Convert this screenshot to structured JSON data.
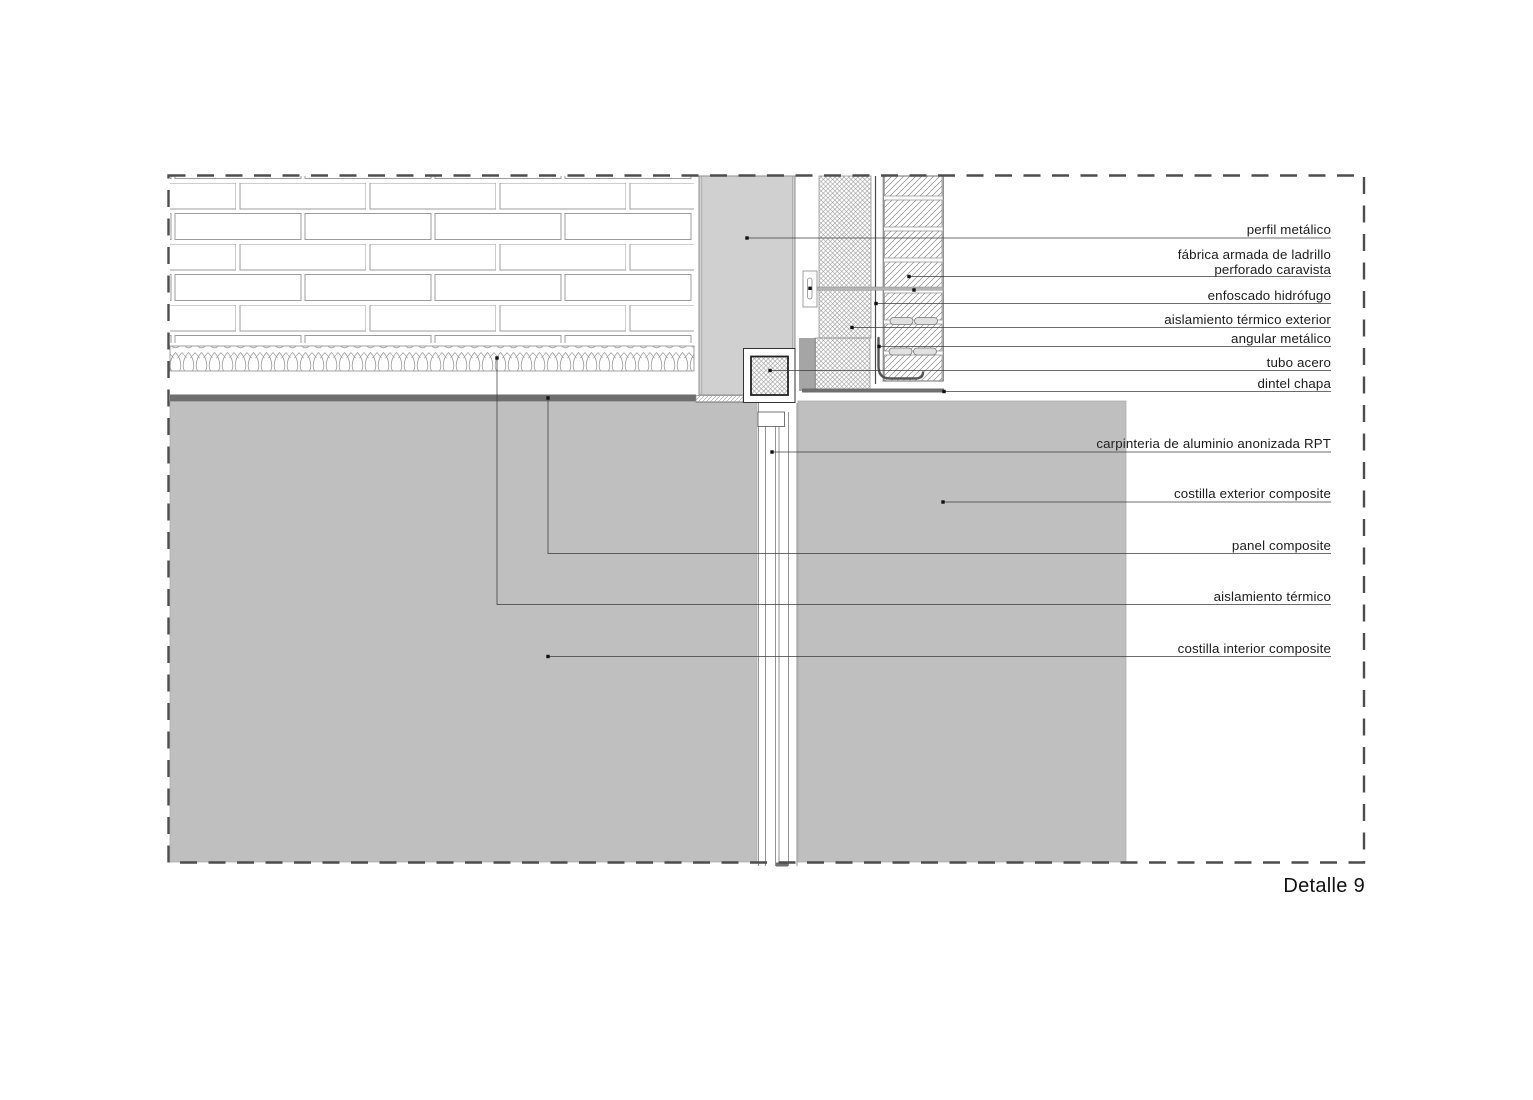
{
  "title": "Detalle 9",
  "callouts": {
    "upper": [
      {
        "label": "perfil metálico"
      },
      {
        "label": "fábrica armada de ladrillo",
        "label_line2": "perforado caravista"
      },
      {
        "label": "enfoscado hidrófugo"
      },
      {
        "label": "aislamiento térmico exterior"
      },
      {
        "label": "angular metálico"
      },
      {
        "label": "tubo acero"
      },
      {
        "label": "dintel chapa"
      }
    ],
    "lower": [
      {
        "label": "carpinteria de aluminio anonizada RPT"
      },
      {
        "label": "costilla exterior composite"
      },
      {
        "label": "panel composite"
      },
      {
        "label": "aislamiento térmico"
      },
      {
        "label": "costilla interior composite"
      }
    ]
  },
  "colors": {
    "slab_gray": "#bfbfbf",
    "column_gray": "#d0d0d0",
    "dark_plate": "#6e6e6e",
    "medium_gray": "#a5a5a5",
    "leader_line": "#3c3c3c"
  }
}
